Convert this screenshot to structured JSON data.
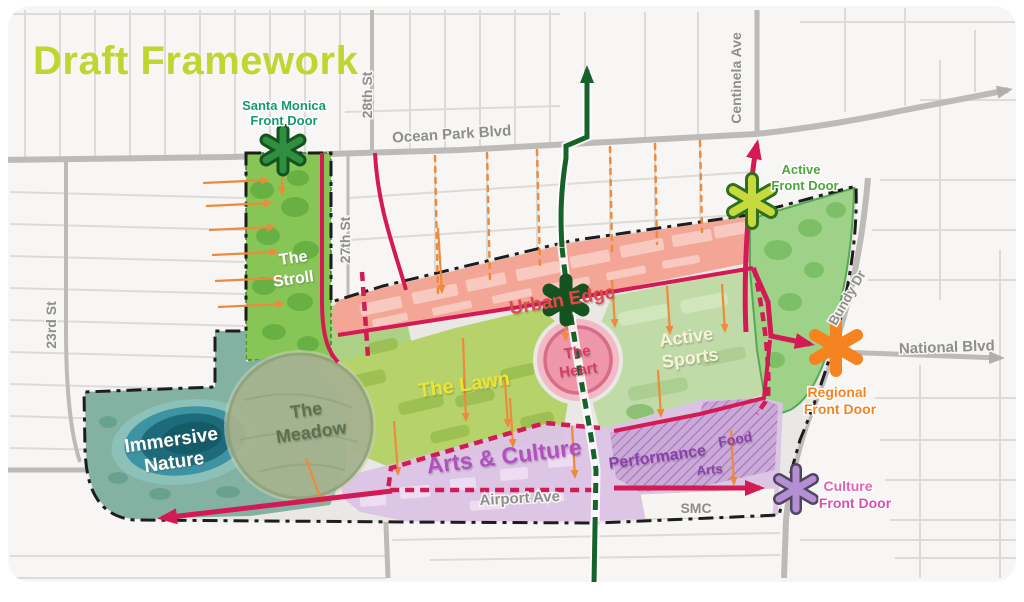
{
  "title": {
    "text": "Draft Framework"
  },
  "zones": {
    "stroll": {
      "line1": "The",
      "line2": "Stroll"
    },
    "immersive_nature": {
      "line1": "Immersive",
      "line2": "Nature"
    },
    "meadow": {
      "line1": "The",
      "line2": "Meadow"
    },
    "lawn": {
      "label": "The Lawn"
    },
    "urban_edge": {
      "label": "Urban Edge"
    },
    "heart": {
      "line1": "The",
      "line2": "Heart"
    },
    "active_sports": {
      "line1": "Active",
      "line2": "Sports"
    },
    "arts_culture": {
      "label": "Arts & Culture"
    },
    "performance": {
      "label": "Performance"
    },
    "food": {
      "label": "Food"
    },
    "arts": {
      "label": "Arts"
    },
    "smc": {
      "label": "SMC"
    }
  },
  "front_doors": {
    "santa_monica": {
      "line1": "Santa Monica",
      "line2": "Front Door"
    },
    "active": {
      "line1": "Active",
      "line2": "Front Door"
    },
    "regional": {
      "line1": "Regional",
      "line2": "Front Door"
    },
    "culture": {
      "line1": "Culture",
      "line2": "Front Door"
    }
  },
  "streets": {
    "ocean_park": "Ocean Park Blvd",
    "st28": "28th St",
    "st27": "27th St",
    "st23": "23rd St",
    "centinela": "Centinela Ave",
    "bundy": "Bundy Dr",
    "national": "National Blvd",
    "airport": "Airport Ave"
  },
  "colors": {
    "title": "#bfd630",
    "crimson_route": "#d31a55",
    "green_route": "#16622b",
    "orange_accent": "#ef8a3c",
    "boundary": "#1d1d1d",
    "stroll_fill": "#87c556",
    "immersive_fill": "#79ad9c",
    "pond_fill": "#1d6b7a",
    "meadow_fill": "#a3b08c",
    "lawn_fill": "#b5d36a",
    "urban_edge_fill": "#f3a596",
    "heart_fill": "#ee97aa",
    "active_sports_fill": "#bedaa4",
    "triangle_park_fill": "#9fd289",
    "arts_culture_fill": "#dcc3e6",
    "santa_monica_fd": "#149a6e",
    "active_fd": "#4aa83a",
    "regional_fd": "#f5831f",
    "culture_fd": "#e163b8"
  }
}
